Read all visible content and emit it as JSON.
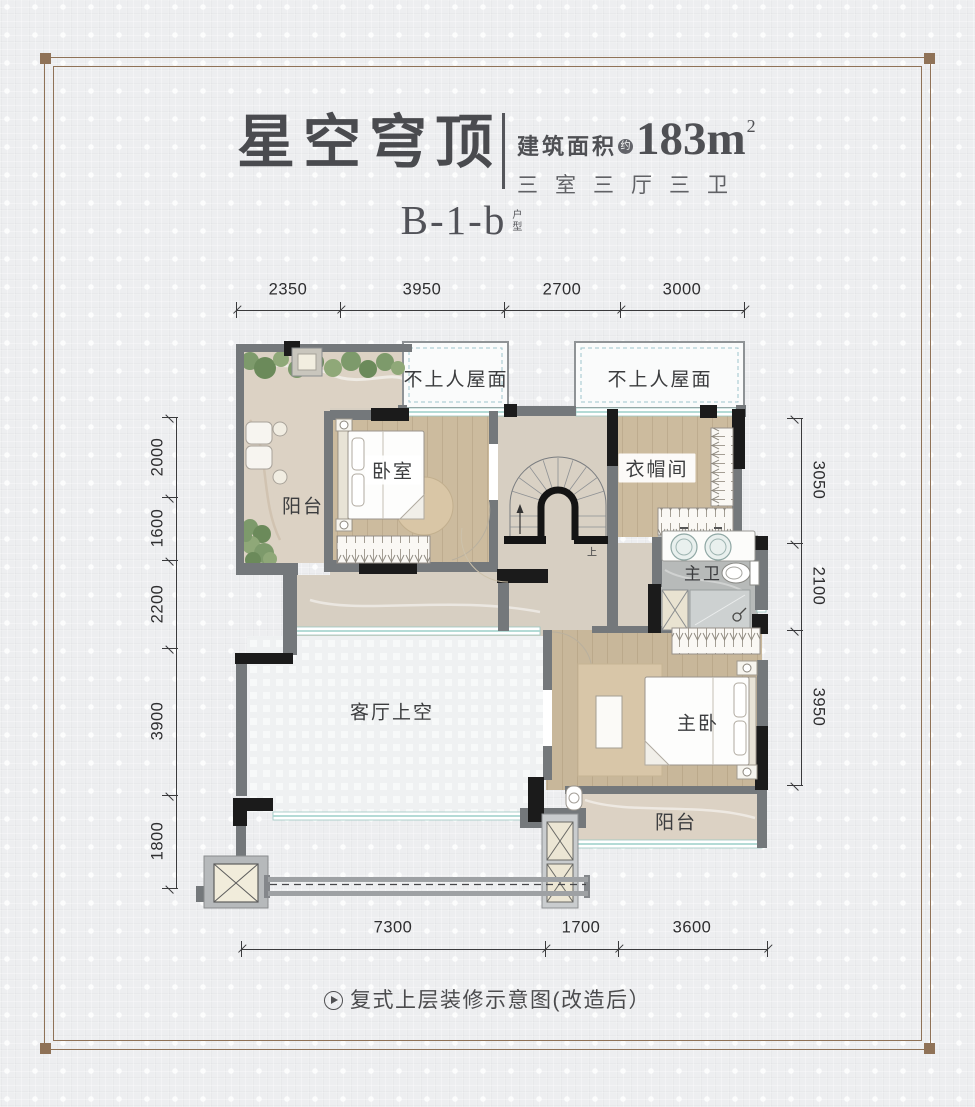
{
  "header": {
    "title": "星空穹顶",
    "area_label": "建筑面积",
    "area_approx": "约",
    "area_value": "183m",
    "area_sup": "2",
    "rooms_summary": "三室三厅三卫",
    "unit_code": "B-1-b",
    "unit_char_1": "户",
    "unit_char_2": "型"
  },
  "dimensions": {
    "top": [
      "2350",
      "3950",
      "2700",
      "3000"
    ],
    "bottom": [
      "7300",
      "1700",
      "3600"
    ],
    "left": [
      "2000",
      "1600",
      "2200",
      "3900",
      "1800"
    ],
    "right": [
      "3050",
      "2100",
      "3950"
    ]
  },
  "plan_labels": {
    "roof_left": "不上人屋面",
    "roof_right": "不上人屋面",
    "balcony_top": "阳台",
    "bedroom": "卧室",
    "cloakroom": "衣帽间",
    "master_bath": "主卫",
    "living_void": "客厅上空",
    "master_bedroom": "主卧",
    "balcony_bottom": "阳台",
    "stairs_up": "上"
  },
  "footer": {
    "caption": "复式上层装修示意图(改造后）"
  },
  "colors": {
    "frame_brown": "#8f7257",
    "title_gray": "#4a4b4f",
    "wall_gray": "#74787b",
    "wall_black": "#1b1b1b",
    "window_teal": "#a9d6d0",
    "wood_floor": "#ccbb9e",
    "marble_floor": "#d7cfc2",
    "bath_floor": "#b7bab9",
    "greenery": "#7d9a6b"
  }
}
